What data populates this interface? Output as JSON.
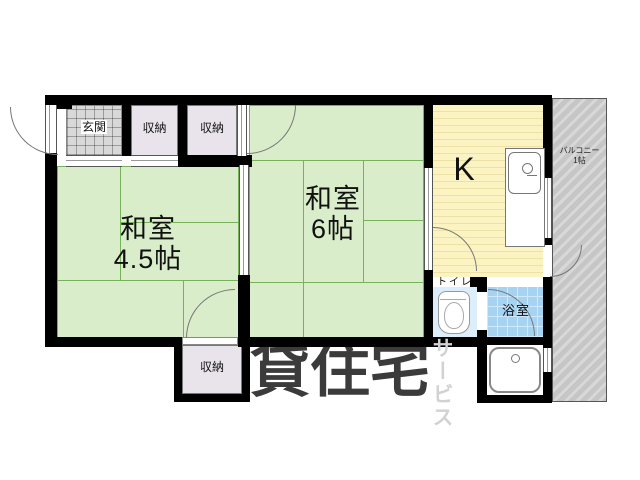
{
  "plan": {
    "watermark": {
      "main": "賃貸住宅",
      "sub": "サービス"
    },
    "rooms": {
      "genkan": {
        "label": "玄関"
      },
      "closet_top_1": {
        "label": "収納"
      },
      "closet_top_2": {
        "label": "収納"
      },
      "closet_bottom": {
        "label": "収納"
      },
      "washitsu_45": {
        "name": "和室",
        "size": "4.5帖"
      },
      "washitsu_6": {
        "name": "和室",
        "size": "6帖"
      },
      "kitchen": {
        "label": "K"
      },
      "toilet": {
        "label": "トイレ"
      },
      "bath": {
        "label": "浴室"
      },
      "balcony": {
        "line1": "バルコニー",
        "line2": "1帖"
      }
    },
    "colors": {
      "wall": "#000000",
      "tatami_fill": "#d9edca",
      "tatami_line": "#76b258",
      "kitchen_fill": "#fcf3c2",
      "closet_fill": "#e9e4ec",
      "toilet_fill": "#dcedfb",
      "bath_fill": "#a7d3f2",
      "genkan_fill": "#ebebeb",
      "balcony_fill": "#c8c8c8",
      "watermark_dark": "#3b3b3b",
      "watermark_light": "#d2d2d2"
    }
  }
}
